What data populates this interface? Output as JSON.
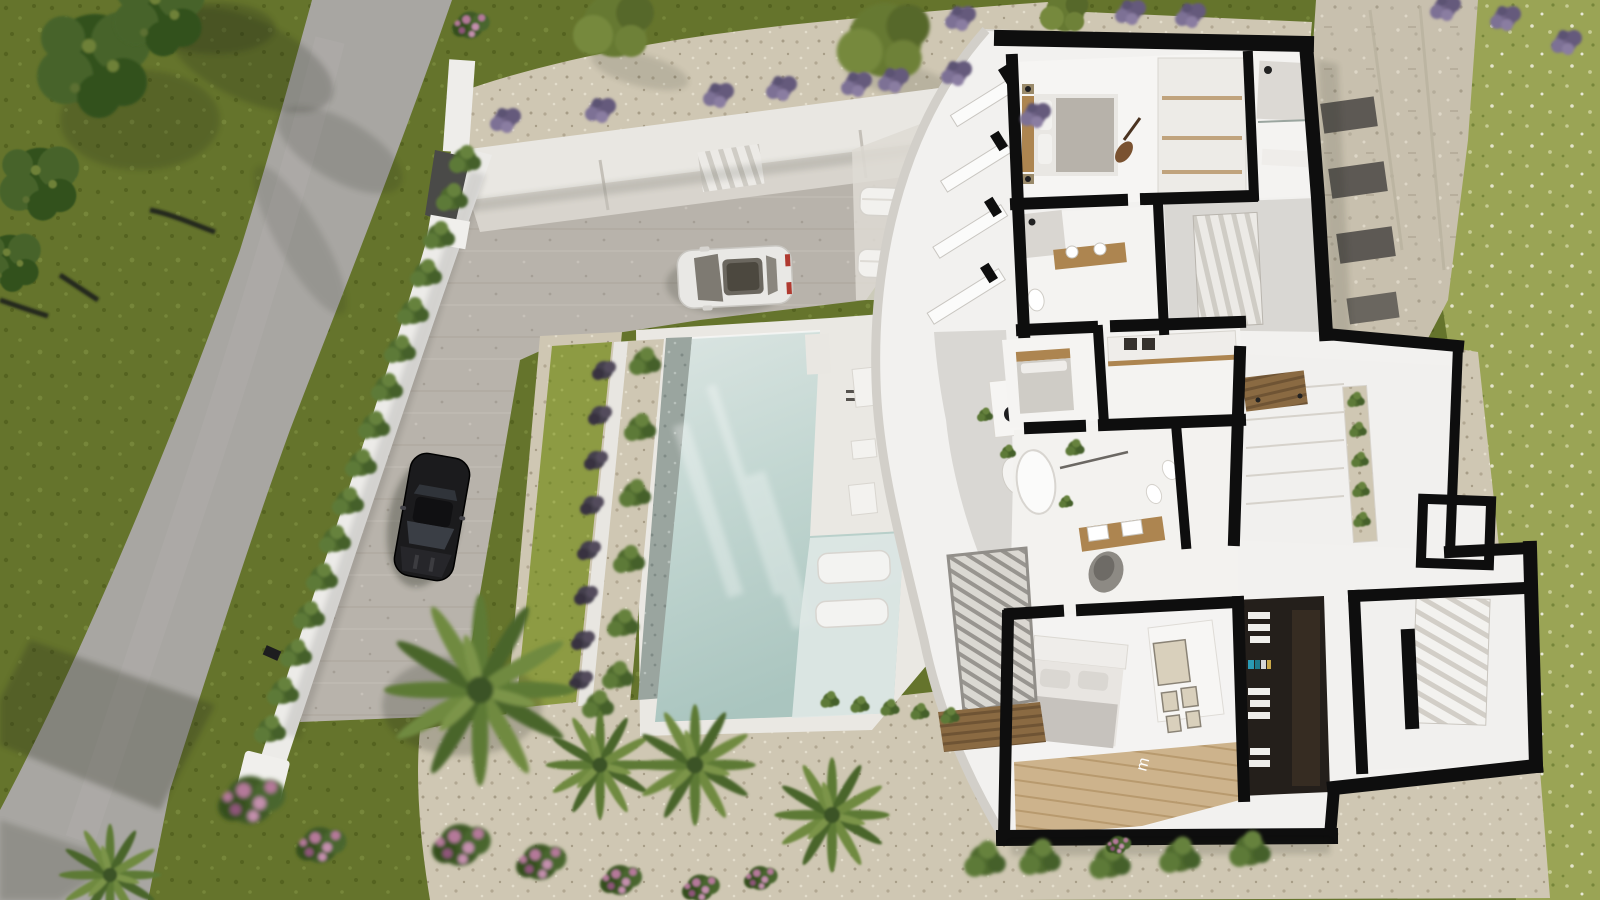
{
  "scene": {
    "type": "architectural-aerial-render",
    "description": "Top-down 3D render of a modern white villa with cutaway floor plan, infinity pool, paved driveway with two sports cars, road and Mediterranean garden",
    "view": "top-down cutaway",
    "decor_letter": "m"
  },
  "palette": {
    "grassDark": "#65742c",
    "grassDot1": "#556320",
    "grassDot2": "#76863a",
    "grassLight": "#9aa455",
    "grassLightDot": "#c6cb94",
    "lawn": "#8d9b43",
    "road": "#a8a6a2",
    "pave": "#b8b3ab",
    "gravel": "#cfc7b3",
    "gravelDot": "#b2a892",
    "stone": "#c8c0ae",
    "pebble": "#9aa59f",
    "deck": "#eae8e3",
    "houseWhite": "#f2f1ef",
    "wallCut": "#0e0e0e",
    "innerGray": "#d9d7d3",
    "poolTop": "#dbe5e2",
    "poolMid": "#c3d7d2",
    "poolDeep": "#aac5bf",
    "ledge": "#dfe8e5",
    "wood": "#ad8550",
    "woodDark": "#8a6a42",
    "closetDark": "#241f1b",
    "hedge": "#44612a",
    "bushLight": "#5d7a38",
    "lavender": "#6f6386",
    "pink": "#b5799a",
    "treeDark": "#33511f",
    "treeMid": "#46632a",
    "treeOlive": "#667932",
    "carWhite": "#e9e8e5",
    "carBlack": "#1b1b1d"
  },
  "objects": {
    "road": "asphalt road along left side",
    "boundary": "white perimeter wall with cypress hedge and entrance gate",
    "driveway": "paved parking forecourt",
    "cars": [
      "white-sports-car",
      "black-sports-car"
    ],
    "pool": "rectangular pool with pebble edge, lawn strip and tanning ledge with two in-water loungers",
    "terrace": "curved white facade terrace with loungers and side tables",
    "rooms": [
      "bedroom-1",
      "ensuite-bathroom",
      "bathroom-2",
      "hall-stairs",
      "bedroom-2",
      "laundry-closet",
      "master-bathroom",
      "garage",
      "patio-planter",
      "utility-room",
      "walk-in-closet",
      "bedroom-3",
      "staircase"
    ],
    "garden": [
      "olive-trees",
      "lavender-row",
      "palm-trees",
      "pink-flower-shrubs",
      "gravel-garden",
      "stone-terraces"
    ]
  }
}
